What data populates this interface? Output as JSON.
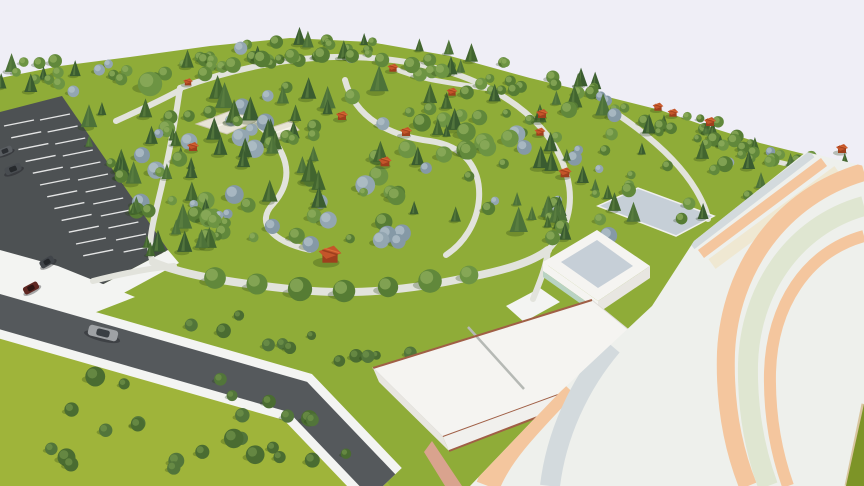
{
  "scene": {
    "description": "aerial-3d-render-park-masterplan",
    "palette": {
      "sky": "#efeef6",
      "grass_park": "#8fac38",
      "grass_field": "#9fb43a",
      "grass_dark": "#7d9427",
      "parking": "#4d5153",
      "asphalt": "#55595c",
      "sidewalk": "#f3f4f2",
      "path": "#e2e3dc",
      "pavilion": "#c4552a",
      "pavilion_dark": "#9e3f1d",
      "pavilion_light": "#dd7038",
      "building_white": "#f5f4f1",
      "building_shade": "#e8e6e1",
      "wall_light": "#f1f0ed",
      "roof_panel": "#c6cfd7",
      "mint": "#b9d3c3",
      "trim": "#a05f46",
      "canopy": "#e8e4d6",
      "canopy_edge": "#cfc9b4",
      "vault_base": "#eef0ec",
      "vault_peach": "#f4c69e",
      "vault_cream": "#efe8d2",
      "vault_sage": "#dfe6d1",
      "vault_blue": "#d3dadd",
      "vault_edge": "#d8c59e",
      "apron": "#d9a38e",
      "shadow": "rgba(35,60,18,0.28)"
    },
    "ground": {
      "park": [
        [
          0,
          78
        ],
        [
          60,
          66
        ],
        [
          130,
          57
        ],
        [
          210,
          46
        ],
        [
          290,
          38
        ],
        [
          370,
          42
        ],
        [
          450,
          56
        ],
        [
          530,
          78
        ],
        [
          600,
          95
        ],
        [
          660,
          110
        ],
        [
          700,
          124
        ],
        [
          760,
          143
        ],
        [
          820,
          158
        ],
        [
          864,
          168
        ],
        [
          864,
          486
        ],
        [
          0,
          486
        ]
      ],
      "field": [
        [
          0,
          330
        ],
        [
          200,
          350
        ],
        [
          330,
          400
        ],
        [
          390,
          486
        ],
        [
          0,
          486
        ]
      ]
    },
    "parking": {
      "outline": [
        [
          0,
          112
        ],
        [
          62,
          96
        ],
        [
          168,
          250
        ],
        [
          98,
          287
        ],
        [
          0,
          282
        ]
      ],
      "stripes": [
        {
          "start": [
            4,
            126
          ],
          "step": [
            7.2,
            11.8
          ],
          "vec": [
            30,
            -6
          ],
          "count": 12
        },
        {
          "start": [
            40,
            120
          ],
          "step": [
            7.6,
            12.0
          ],
          "vec": [
            30,
            -6
          ],
          "count": 12
        }
      ]
    },
    "sidewalk_areas": [
      [
        [
          0,
          250
        ],
        [
          58,
          266
        ],
        [
          135,
          297
        ],
        [
          86,
          316
        ],
        [
          0,
          306
        ]
      ],
      [
        [
          98,
          287
        ],
        [
          168,
          250
        ],
        [
          179,
          263
        ],
        [
          109,
          301
        ]
      ],
      [
        [
          506,
          306
        ],
        [
          540,
          288
        ],
        [
          560,
          302
        ],
        [
          524,
          322
        ]
      ]
    ],
    "roads": [
      {
        "points": "-6,310 298,397 383,486",
        "asphalt_w": 34,
        "sidewalk_w": 52
      }
    ],
    "paths": [
      {
        "d": "M180,88 C174,130 166,170 156,210 C150,235 148,252 153,262",
        "w": 6
      },
      {
        "d": "M153,262 C185,276 240,284 300,290 C360,296 420,288 470,277 C506,270 532,262 548,250",
        "w": 8
      },
      {
        "d": "M180,88 C240,66 300,56 350,57 C400,58 452,68 490,89 C532,111 558,141 567,176 C575,206 566,232 548,250",
        "w": 6
      },
      {
        "d": "M250,118 C290,148 296,178 273,204 C256,222 270,241 310,250",
        "w": 6
      },
      {
        "d": "M345,80 C355,118 390,136 430,141 C466,146 481,170 479,199 C477,224 463,244 446,255",
        "w": 6
      },
      {
        "d": "M393,68 C420,80 452,83 490,89",
        "w": 5
      },
      {
        "d": "M620,116 C655,140 681,165 696,190 C703,202 707,211 708,219",
        "w": 6
      },
      {
        "d": "M778,162 C812,170 840,176 864,181",
        "w": 5
      },
      {
        "d": "M548,250 C546,268 539,284 533,299",
        "w": 6
      },
      {
        "d": "M116,121 C138,111 160,101 180,90",
        "w": 6
      },
      {
        "d": "M93,281 C128,272 152,268 174,266",
        "w": 6
      }
    ],
    "accent_trees": {
      "bottom_row": {
        "r": 11,
        "pts": [
          [
            215,
            278
          ],
          [
            257,
            284
          ],
          [
            300,
            289
          ],
          [
            344,
            291
          ],
          [
            388,
            287
          ],
          [
            430,
            281
          ],
          [
            469,
            275
          ]
        ]
      },
      "top_row": {
        "r": 8,
        "pts": [
          [
            205,
            74
          ],
          [
            233,
            65
          ],
          [
            262,
            59
          ],
          [
            292,
            56
          ],
          [
            322,
            55
          ],
          [
            352,
            56
          ],
          [
            382,
            60
          ],
          [
            412,
            65
          ],
          [
            442,
            71
          ]
        ]
      },
      "landmark": {
        "r": 13,
        "pts": [
          [
            150,
            84
          ]
        ]
      }
    },
    "tree_regions": [
      {
        "quad": [
          [
            0,
            60
          ],
          [
            95,
            60
          ],
          [
            95,
            96
          ],
          [
            0,
            96
          ]
        ],
        "count": 14,
        "size": [
          4,
          7
        ],
        "mix": {
          "round": 0.75,
          "conifer": 0.15,
          "blue": 0.1
        }
      },
      {
        "quad": [
          [
            95,
            58
          ],
          [
            300,
            34
          ],
          [
            300,
            62
          ],
          [
            95,
            90
          ]
        ],
        "count": 26,
        "size": [
          4,
          7
        ],
        "mix": {
          "round": 0.7,
          "conifer": 0.2,
          "blue": 0.1
        }
      },
      {
        "quad": [
          [
            300,
            34
          ],
          [
            460,
            50
          ],
          [
            460,
            80
          ],
          [
            300,
            62
          ]
        ],
        "count": 20,
        "size": [
          4,
          7
        ],
        "mix": {
          "round": 0.65,
          "conifer": 0.25,
          "blue": 0.1
        }
      },
      {
        "quad": [
          [
            460,
            50
          ],
          [
            620,
            92
          ],
          [
            620,
            122
          ],
          [
            460,
            80
          ]
        ],
        "count": 22,
        "size": [
          4,
          7
        ],
        "mix": {
          "round": 0.7,
          "conifer": 0.2,
          "blue": 0.1
        }
      },
      {
        "quad": [
          [
            620,
            92
          ],
          [
            820,
            150
          ],
          [
            820,
            174
          ],
          [
            620,
            122
          ]
        ],
        "count": 28,
        "size": [
          4,
          7
        ],
        "mix": {
          "round": 0.75,
          "conifer": 0.15,
          "blue": 0.1
        }
      },
      {
        "quad": [
          [
            150,
            95
          ],
          [
            460,
            75
          ],
          [
            545,
            235
          ],
          [
            165,
            255
          ]
        ],
        "count": 115,
        "size": [
          4,
          10
        ],
        "mix": {
          "round": 0.38,
          "conifer": 0.42,
          "blue": 0.2
        }
      },
      {
        "quad": [
          [
            470,
            85
          ],
          [
            640,
            110
          ],
          [
            700,
            222
          ],
          [
            552,
            246
          ]
        ],
        "count": 50,
        "size": [
          4,
          9
        ],
        "mix": {
          "round": 0.5,
          "conifer": 0.35,
          "blue": 0.15
        }
      },
      {
        "quad": [
          [
            70,
            118
          ],
          [
            160,
            103
          ],
          [
            235,
            242
          ],
          [
            150,
            262
          ]
        ],
        "count": 36,
        "size": [
          4,
          9
        ],
        "mix": {
          "round": 0.25,
          "conifer": 0.65,
          "blue": 0.1
        }
      },
      {
        "quad": [
          [
            695,
            128
          ],
          [
            825,
            162
          ],
          [
            795,
            215
          ],
          [
            688,
            232
          ]
        ],
        "count": 26,
        "size": [
          4,
          8
        ],
        "mix": {
          "round": 0.6,
          "conifer": 0.3,
          "blue": 0.1
        }
      },
      {
        "quad": [
          [
            826,
            155
          ],
          [
            864,
            170
          ],
          [
            864,
            212
          ],
          [
            818,
            205
          ]
        ],
        "count": 10,
        "size": [
          4,
          7
        ],
        "mix": {
          "round": 0.6,
          "conifer": 0.3,
          "blue": 0.1
        }
      },
      {
        "quad": [
          [
            515,
            198
          ],
          [
            562,
            204
          ],
          [
            560,
            240
          ],
          [
            513,
            234
          ]
        ],
        "count": 8,
        "size": [
          4,
          8
        ],
        "mix": {
          "round": 0.6,
          "conifer": 0.3,
          "blue": 0.1
        }
      },
      {
        "quad": [
          [
            10,
            352
          ],
          [
            300,
            384
          ],
          [
            358,
            468
          ],
          [
            20,
            468
          ]
        ],
        "count": 26,
        "size": [
          5,
          10
        ],
        "mix": {
          "bush": 1
        }
      },
      {
        "quad": [
          [
            140,
            295
          ],
          [
            428,
            352
          ],
          [
            418,
            378
          ],
          [
            130,
            320
          ]
        ],
        "count": 12,
        "size": [
          4,
          8
        ],
        "mix": {
          "bush": 1
        }
      }
    ],
    "pavilions": [
      [
        188,
        83,
        0.8
      ],
      [
        193,
        148,
        1.0
      ],
      [
        330,
        257,
        1.9
      ],
      [
        342,
        117,
        1.0
      ],
      [
        393,
        69,
        0.9
      ],
      [
        406,
        133,
        1.0
      ],
      [
        385,
        163,
        1.1
      ],
      [
        452,
        93,
        0.9
      ],
      [
        542,
        115,
        1.0
      ],
      [
        540,
        133,
        0.9
      ],
      [
        658,
        108,
        0.9
      ],
      [
        673,
        114,
        0.9
      ],
      [
        710,
        123,
        1.0
      ],
      [
        565,
        174,
        1.1
      ],
      [
        842,
        150,
        1.0
      ]
    ],
    "canopies": [
      {
        "pts": [
          [
            196,
            124
          ],
          [
            230,
            111
          ],
          [
            259,
            120
          ],
          [
            227,
            134
          ]
        ],
        "ridge": [
          [
            213,
            128
          ],
          [
            244,
            116
          ]
        ]
      },
      {
        "pts": [
          [
            267,
            129
          ],
          [
            291,
            121
          ],
          [
            299,
            130
          ],
          [
            277,
            140
          ]
        ],
        "ridge": [
          [
            272,
            134
          ],
          [
            295,
            126
          ]
        ]
      }
    ],
    "buildings": {
      "rear": {
        "pts": [
          [
            598,
            206
          ],
          [
            676,
            236
          ],
          [
            714,
            216
          ],
          [
            638,
            188
          ]
        ]
      },
      "box": {
        "base": [
          [
            543,
            262
          ],
          [
            597,
            230
          ],
          [
            650,
            266
          ],
          [
            598,
            301
          ]
        ],
        "panel": [
          [
            561,
            262
          ],
          [
            597,
            240
          ],
          [
            633,
            266
          ],
          [
            598,
            288
          ]
        ],
        "wall_w_top": [
          [
            543,
            262
          ],
          [
            598,
            301
          ],
          [
            598,
            310
          ],
          [
            543,
            271
          ]
        ],
        "wall_w_mint": [
          [
            543,
            271
          ],
          [
            598,
            310
          ],
          [
            598,
            316
          ],
          [
            543,
            277
          ]
        ],
        "wall_s": [
          [
            598,
            301
          ],
          [
            650,
            266
          ],
          [
            650,
            278
          ],
          [
            598,
            313
          ]
        ]
      },
      "long": {
        "roof": [
          [
            373,
            368
          ],
          [
            592,
            300
          ],
          [
            662,
            357
          ],
          [
            443,
            437
          ]
        ],
        "joint": [
          [
            468,
            327
          ],
          [
            524,
            389
          ]
        ],
        "trim_nw": [
          [
            373,
            368
          ],
          [
            592,
            300
          ]
        ],
        "trim_se": [
          [
            443,
            437
          ],
          [
            662,
            357
          ]
        ],
        "wall_sw": [
          [
            373,
            368
          ],
          [
            443,
            437
          ],
          [
            449,
            451
          ],
          [
            379,
            382
          ]
        ],
        "wall_se": [
          [
            443,
            437
          ],
          [
            662,
            357
          ],
          [
            668,
            367
          ],
          [
            449,
            451
          ]
        ],
        "base_line": [
          [
            449,
            451
          ],
          [
            668,
            367
          ]
        ],
        "apron": [
          [
            432,
            441
          ],
          [
            462,
            486
          ],
          [
            445,
            486
          ],
          [
            424,
            452
          ]
        ]
      }
    },
    "vault": {
      "outline": [
        [
          694,
          241
        ],
        [
          806,
          152
        ],
        [
          864,
          166
        ],
        [
          864,
          404
        ],
        [
          846,
          486
        ],
        [
          470,
          486
        ],
        [
          560,
          392
        ],
        [
          652,
          306
        ]
      ],
      "bands": [
        {
          "d": "M692,246 L812,154",
          "w": 8,
          "c": "vault_blue"
        },
        {
          "d": "M701,254 L824,162",
          "w": 10,
          "c": "vault_peach"
        },
        {
          "d": "M712,264 L838,171",
          "w": 12,
          "c": "vault_cream"
        },
        {
          "d": "M864,172 C780,196 730,270 726,352 C724,412 736,456 748,486",
          "w": 18,
          "c": "vault_peach"
        },
        {
          "d": "M864,206 C792,226 750,292 748,364 C747,416 757,456 768,486",
          "w": 20,
          "c": "vault_sage"
        },
        {
          "d": "M864,236 C806,252 772,306 770,372 C769,420 778,458 788,486",
          "w": 12,
          "c": "vault_peach"
        },
        {
          "d": "M566,386 C530,424 500,454 488,486",
          "w": 24,
          "c": "vault_peach"
        },
        {
          "d": "M612,346 C578,386 556,436 550,486",
          "w": 20,
          "c": "vault_blue"
        }
      ],
      "edge_line": [
        [
          864,
          404
        ],
        [
          847,
          486
        ]
      ],
      "grass_corner": [
        [
          864,
          404
        ],
        [
          864,
          486
        ],
        [
          846,
          486
        ]
      ]
    },
    "cars": [
      {
        "x": 103,
        "y": 333,
        "r": 14,
        "l": 30,
        "w": 11,
        "body": "#9fa2a5",
        "top": "#3a3f44"
      },
      {
        "x": 31,
        "y": 288,
        "r": -28,
        "l": 16,
        "w": 8,
        "body": "#5f2823",
        "top": "#2e1513"
      },
      {
        "x": 47,
        "y": 262,
        "r": -30,
        "l": 15,
        "w": 8,
        "body": "#41454a",
        "top": "#23262a"
      },
      {
        "x": 13,
        "y": 169,
        "r": -22,
        "l": 17,
        "w": 8,
        "body": "#484c50",
        "top": "#26292c"
      },
      {
        "x": 5,
        "y": 151,
        "r": -22,
        "l": 15,
        "w": 7,
        "body": "#595d61",
        "top": "#2c2f33"
      }
    ]
  }
}
